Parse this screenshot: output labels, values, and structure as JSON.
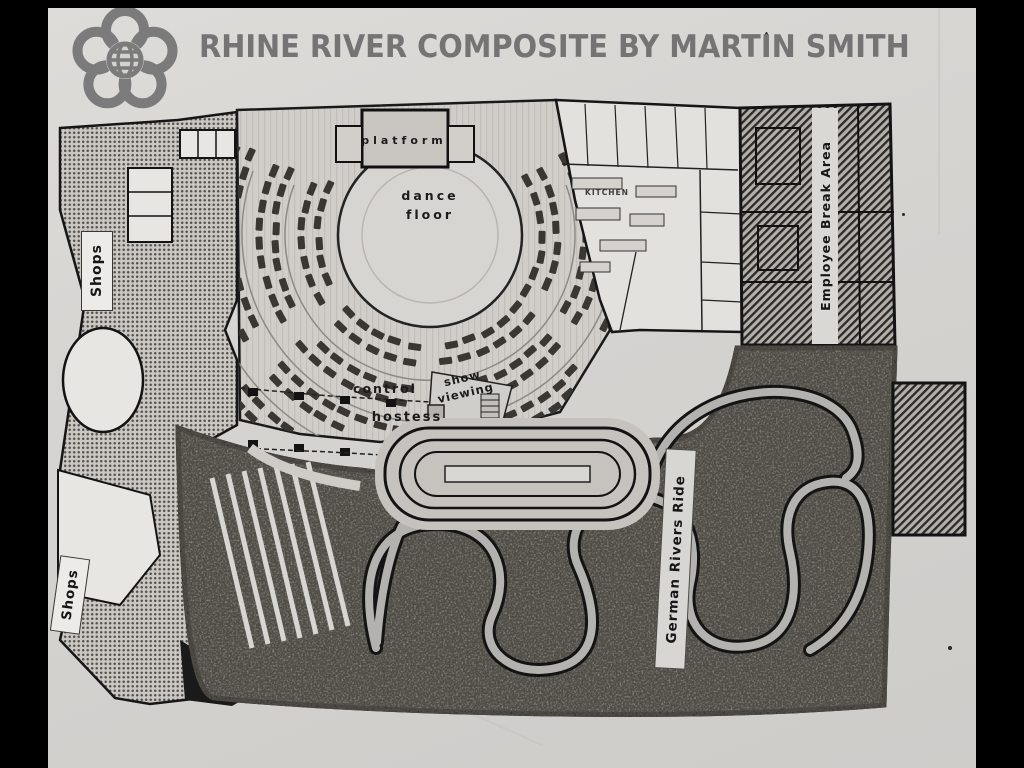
{
  "header": {
    "title": "RHINE RIVER COMPOSITE BY MARTIN SMITH",
    "logo_icon": "epcot-center-logo"
  },
  "plan": {
    "labels": {
      "shops_upper": "Shops",
      "shops_lower": "Shops",
      "platform": "platform",
      "dance_floor": "dance\nfloor",
      "control": "control",
      "show_viewing": "show\nviewing",
      "hostess": "hostess",
      "kitchen": "KITCHEN",
      "german_rivers_ride": "German Rivers Ride",
      "employee_break_area": "Employee Break Area"
    },
    "palette": {
      "letterbox_bar": "#000000",
      "paper": "#d6d4d1",
      "title_gray": "#747474",
      "logo_gray": "#7b7b7b",
      "ink": "#1a1a1a",
      "stipple_dot": "#56524d",
      "hatch_dark": "#2c2a27",
      "forest_base": "#97948f",
      "river_water": "#b4b2ae",
      "table_dark": "#3a3733"
    }
  }
}
